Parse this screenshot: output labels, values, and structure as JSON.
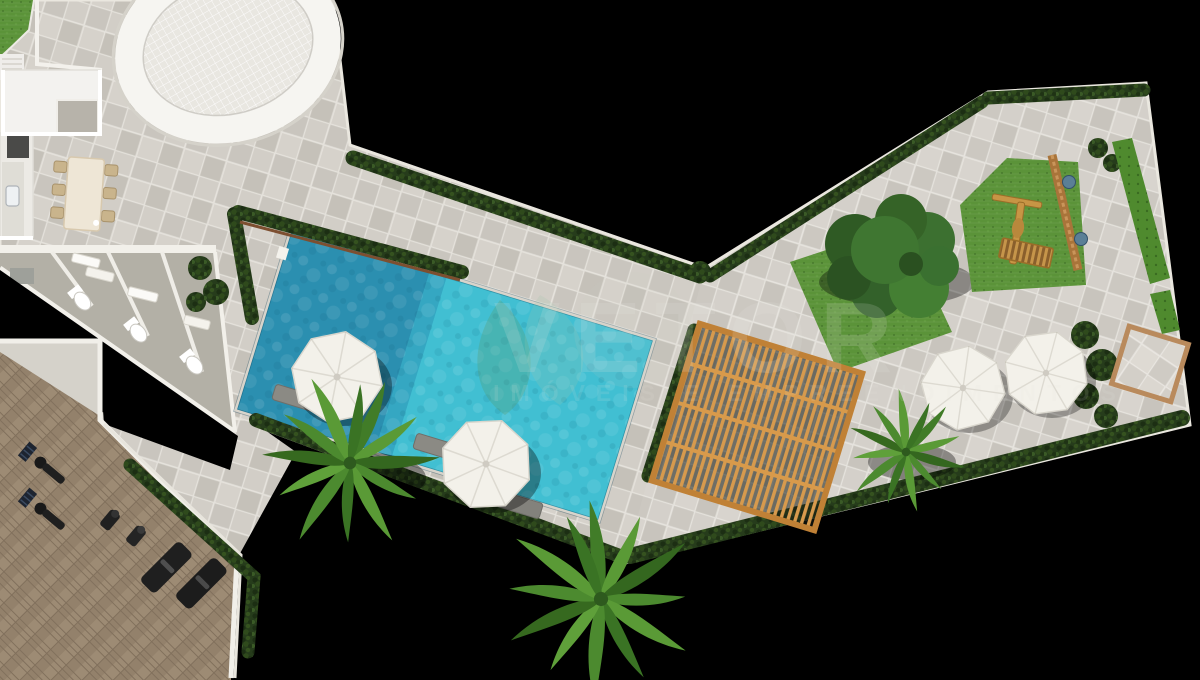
{
  "canvas": {
    "width": 1200,
    "height": 680,
    "background": "#000000"
  },
  "watermark": {
    "brand": "VETOR",
    "tagline": "IMÓVEIS E EMPREENDIMENTOS",
    "logo": "leaf-drop-icon",
    "text_color": "rgba(230,230,225,0.16)"
  },
  "scene": {
    "type": "architectural-site-plan-top-view",
    "description": "Aerial 3D render of a condominium leisure deck",
    "features": [
      {
        "name": "swimming-pool",
        "water_light": "#41bfd2",
        "water_deep": "#2b8fb0"
      },
      {
        "name": "pool-deck-paving",
        "color": "#ccc8c1"
      },
      {
        "name": "oval-mosaic-plaza",
        "color": "#e9e7e1"
      },
      {
        "name": "wood-pergola",
        "color": "#d79a4d"
      },
      {
        "name": "gym-herringbone-floor",
        "color": "#93816b"
      },
      {
        "name": "treadmills-and-benches",
        "color": "#1f1f1f"
      },
      {
        "name": "restroom-stalls",
        "floor": "#b3b0a6",
        "fixtures": "#ffffff"
      },
      {
        "name": "party-room-with-kitchen",
        "floor": "#f3f2ef"
      },
      {
        "name": "dining-table-six-chairs",
        "color": "#eee6d6"
      },
      {
        "name": "white-umbrellas",
        "count": 4,
        "color": "#f3f1ea"
      },
      {
        "name": "sun-loungers",
        "color": "#8b8a84"
      },
      {
        "name": "palm-trees",
        "count": 3,
        "color": "#4c8a2f"
      },
      {
        "name": "shade-tree",
        "color": "#38682c"
      },
      {
        "name": "lawns-and-hedges",
        "lawn": "#5b9339",
        "hedge": "#263c1b"
      },
      {
        "name": "playground-lawn-with-wood-structure",
        "wood": "#c79545"
      },
      {
        "name": "bordered-patio-square",
        "border": "#b98a5c"
      }
    ]
  }
}
